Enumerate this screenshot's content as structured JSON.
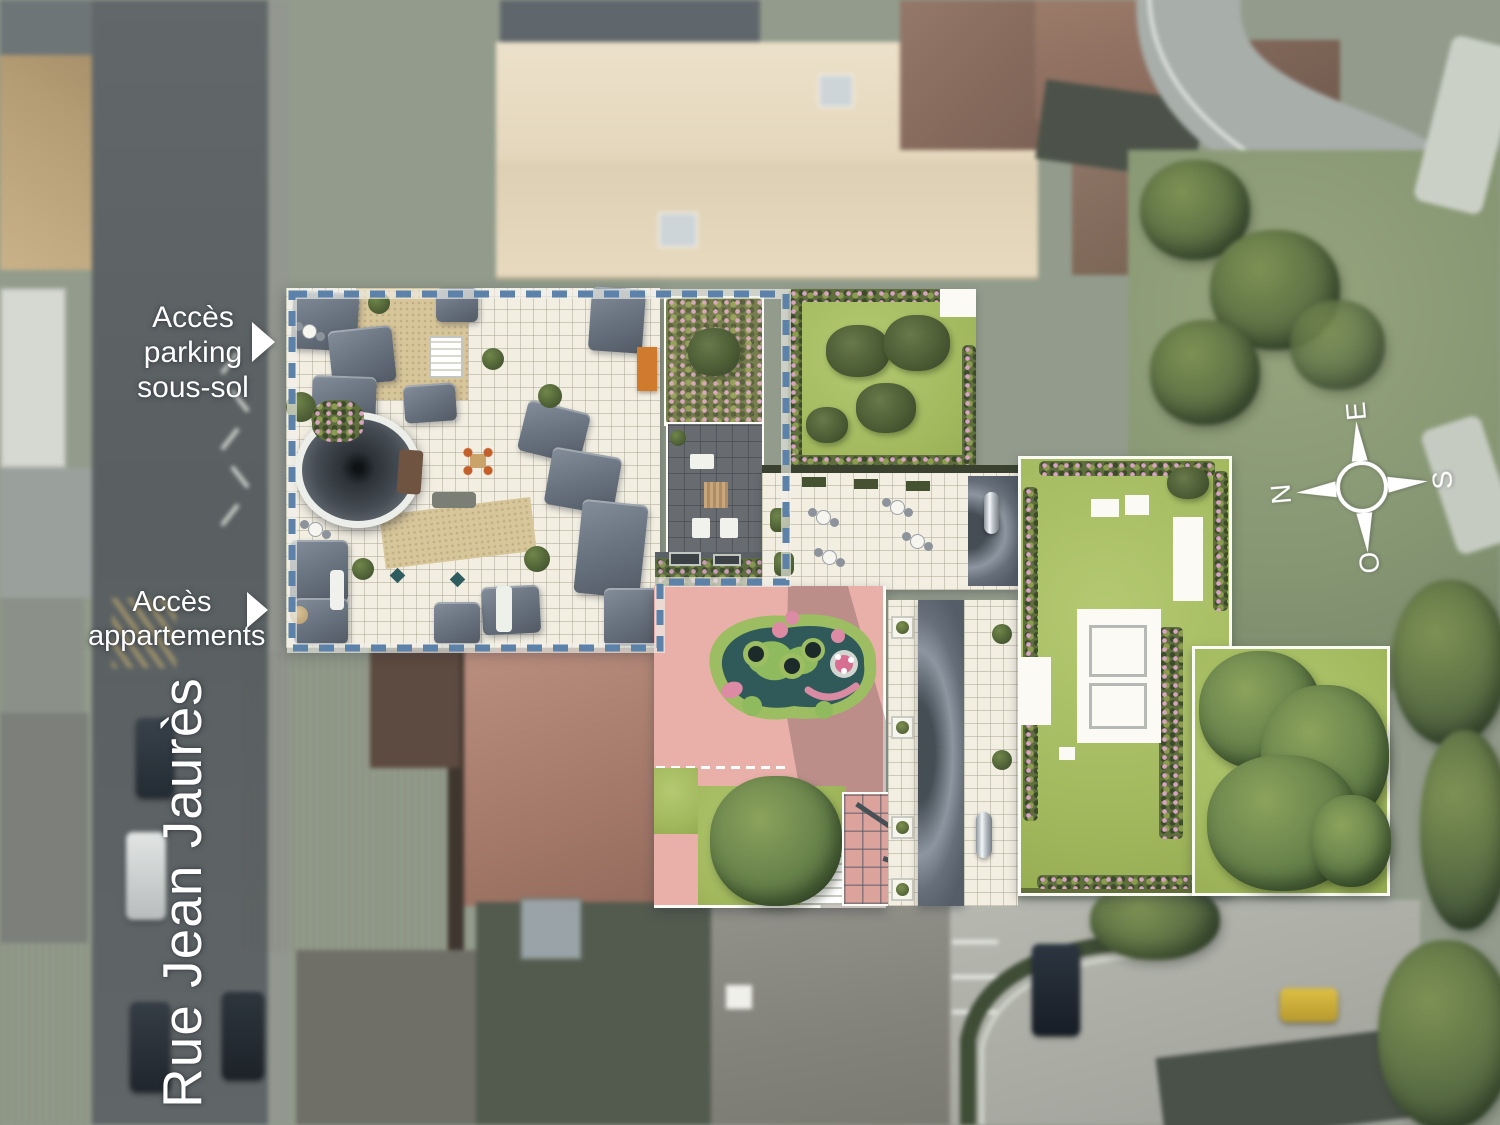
{
  "site_plan": {
    "labels": {
      "access_parking": "Accès parking sous-sol",
      "access_parking_lines": [
        "Accès",
        "parking",
        "sous-sol"
      ],
      "access_apartments": "Accès appartements",
      "access_apartments_lines": [
        "Accès",
        "appartements"
      ],
      "street_name": "Rue Jean Jaurès"
    },
    "compass": {
      "north": "N",
      "east": "E",
      "south": "S",
      "west": "O"
    },
    "colors": {
      "boundary_dashed_blue": "#5c82aa",
      "courtyard_pink": "#e9b0aa",
      "lawn_green": "#a4ba62",
      "roof_slate_gray": "#6a7480",
      "terrace_tile_white": "#f2eee3",
      "playground_teal": "#2f5a59",
      "playground_ring_green": "#9dbd62",
      "awning_orange": "#d07a2e",
      "label_text": "#ffffff"
    }
  }
}
